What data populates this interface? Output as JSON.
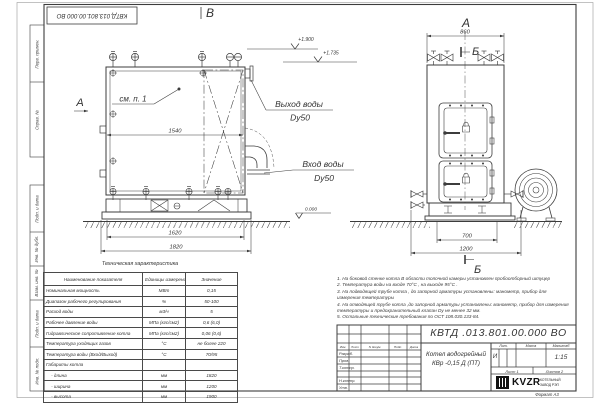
{
  "stamp_top_left": "КВТД.013.801.00.000  ВО",
  "margin_labels": [
    "Перв. примен.",
    "Справ. №",
    "Подп. и дата",
    "Инв. № дубл.",
    "Взам. инв. №",
    "Подп. и дата",
    "Инв. № подл."
  ],
  "drawing": {
    "front_view": {
      "label": "В",
      "arrow_label": "А",
      "see_item": "см. п. 1",
      "dims": {
        "inner_width": "1540",
        "frame_width": "1620",
        "overall_width": "1820"
      },
      "elevations": {
        "top": "+1.900",
        "mid": "+1.735",
        "zero": "0.000"
      },
      "outlet": {
        "line1": "Выход воды",
        "line2": "Dy50"
      },
      "inlet": {
        "line1": "Вход воды",
        "line2": "Dy50"
      }
    },
    "side_view": {
      "label": "А",
      "cut_label_top": "Б",
      "cut_label_bottom": "Б",
      "dims": {
        "top_width": "860",
        "base_width": "700",
        "overall_width": "1200"
      }
    }
  },
  "tech_table": {
    "title": "Техническая характеристика",
    "headers": [
      "Наименование показателя",
      "Единицы измерения",
      "Значение"
    ],
    "rows": [
      [
        "Номинальная мощность",
        "МВт",
        "0,15"
      ],
      [
        "Диапазон рабочего регулирования",
        "%",
        "50-100"
      ],
      [
        "Расход воды",
        "м3/ч",
        "5"
      ],
      [
        "Рабочее давление воды",
        "МПа (кгс/см2)",
        "0,6 (6,0)"
      ],
      [
        "Гидравлическое сопротивление котла",
        "МПа (кгс/см2)",
        "0,06 (0,6)"
      ],
      [
        "Температура уходящих газов",
        "°С",
        "не более 220"
      ],
      [
        "Температура воды (Вход/Выход)",
        "°С",
        "70/95"
      ],
      [
        "Габариты котла",
        "",
        ""
      ],
      [
        "    - длина",
        "мм",
        "1820"
      ],
      [
        "    - ширина",
        "мм",
        "1200"
      ],
      [
        "    - высота",
        "мм",
        "1900"
      ]
    ]
  },
  "notes": [
    "1.  На боковой стенке котла В области топочной камеры установлен пробоотборный штуцер",
    "2.  Температура воды на входе  70°С ,  на выходе  95°С .",
    "3.  На подводящей трубе котла , до запорной арматуры установлены: манометр, прибор для измерения температуры",
    "4.  На отводящей трубе котла ,до запорной арматуры установлены: манометр, прибор для измерения температуры и предохранительный клапан  Dу не менее  32  мм.",
    "5.  Остальные технические требования по  ОСТ  108.030.133-84."
  ],
  "title_block": {
    "doc_number": "КВТД .013.801.00.000  ВО",
    "product_line1": "Котел водогрейный",
    "product_line2": "КВр -0,15  Д  (ПТ)",
    "col_lit": "Лит.",
    "col_mass": "Масса",
    "col_scale": "Масштаб",
    "lit_value": "И",
    "scale_value": "1:15",
    "sheet": "Лист   1",
    "sheets": "Листов   2",
    "rev_headers": [
      "Изм.",
      "Лист",
      "N докум.",
      "Подп.",
      "Дата"
    ],
    "roles": [
      "Разраб.",
      "Пров.",
      "Т.контр.",
      "Н.контр.",
      "Утв."
    ],
    "logo_text": "KVZR",
    "logo_caption1": "КОТЕЛЬНЫЙ",
    "logo_caption2": "ЗАВОД РЭП",
    "format_label": "Формат    А3"
  }
}
